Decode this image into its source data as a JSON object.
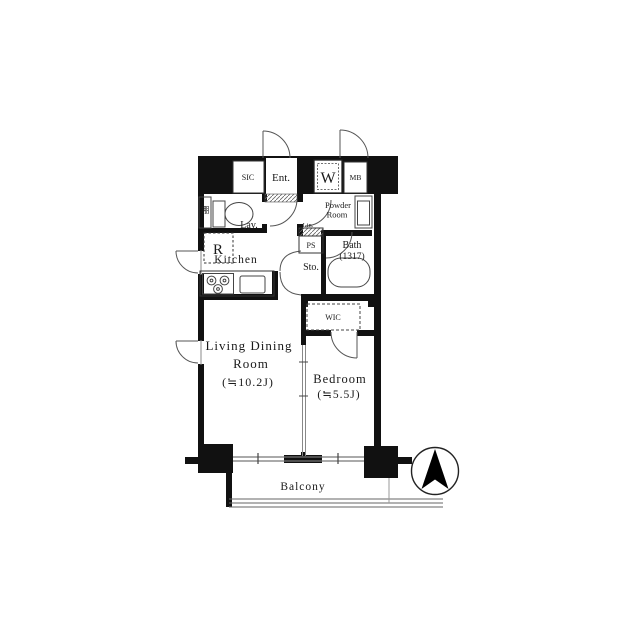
{
  "labels": {
    "sic": "SIC",
    "entrance": "Ent.",
    "washing_machine": "W",
    "meter_box": "MB",
    "powder_room_1": "Powder",
    "powder_room_2": "Room",
    "bath": "Bath",
    "bath_size": "(1317)",
    "shelf": "棚",
    "lavatory": "Lav.",
    "refrigerator": "R",
    "kitchen": "Kitchen",
    "linen": "Lin.",
    "pipe_space": "PS",
    "storage": "Sto.",
    "walk_in_closet": "WIC",
    "living_1": "Living Dining",
    "living_2": "Room",
    "living_size": "(≒10.2J)",
    "bedroom": "Bedroom",
    "bedroom_size": "(≒5.5J)",
    "balcony": "Balcony"
  },
  "colors": {
    "wall": "#111111",
    "fixture_line": "#555555",
    "sliding_line": "#888888"
  }
}
